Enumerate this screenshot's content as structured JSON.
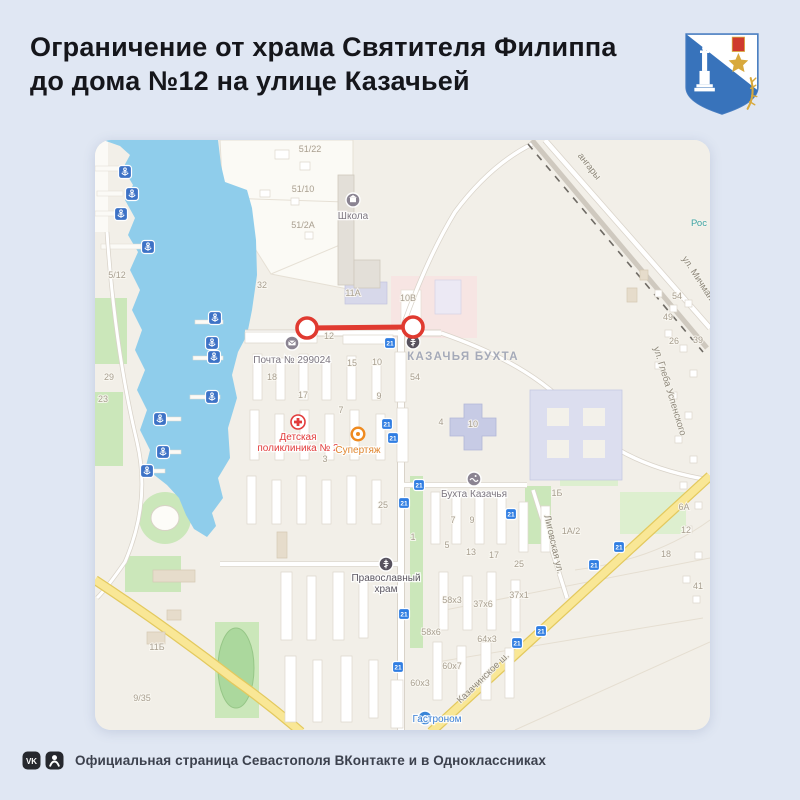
{
  "colors": {
    "page_bg": "#e0e7f3",
    "map_bg": "#f2efe8",
    "water": "#8fcdeb",
    "restriction_red": "#e03a30",
    "yellow_road": "#f9e796",
    "transit_blue": "#2f7de2",
    "anchor_blue": "#3d72c6"
  },
  "header": {
    "title_line1": "Ограничение от храма Святителя Филиппа",
    "title_line2": "до дома №12 на улице Казачьей",
    "emblem_name": "sevastopol-coat-of-arms"
  },
  "footer": {
    "text": "Официальная страница Севастополя ВКонтакте и в Одноклассниках",
    "icons": [
      "vk-icon",
      "ok-icon"
    ]
  },
  "map": {
    "area_label": {
      "text": "КАЗАЧЬЯ БУХТА",
      "x": 368,
      "y": 220
    },
    "restriction": {
      "x1": 212,
      "y1": 188,
      "x2": 318,
      "y2": 187,
      "color": "#e03a30"
    },
    "street_labels": [
      {
        "text": "ангары",
        "x": 492,
        "y": 28,
        "angle": 52
      },
      {
        "text": "ул. Мичманская",
        "x": 606,
        "y": 148,
        "angle": 57
      },
      {
        "text": "ул. Глеба Успенского",
        "x": 572,
        "y": 252,
        "angle": 73
      },
      {
        "text": "Лиговская ул.",
        "x": 456,
        "y": 405,
        "angle": 77
      },
      {
        "text": "Казачинское ш.",
        "x": 390,
        "y": 540,
        "angle": -44
      },
      {
        "text": "Рос",
        "x": 604,
        "y": 86,
        "angle": 0,
        "color": "#3fa3a3"
      }
    ],
    "poi": [
      {
        "name": "school",
        "icon": "school-icon",
        "x": 258,
        "y": 60,
        "lines": [
          "Школа"
        ],
        "ly": 79,
        "color": "#7d7781"
      },
      {
        "name": "post-office",
        "icon": "post-icon",
        "x": 197,
        "y": 203,
        "lines": [
          "Почта № 299024"
        ],
        "ly": 223,
        "color": "#7d7781"
      },
      {
        "name": "church-svyatitelya-filippa",
        "icon": "church-icon",
        "x": 318,
        "y": 202,
        "lines": [],
        "ly": 0,
        "color": "#5a5560"
      },
      {
        "name": "children-clinic",
        "icon": "clinic-icon",
        "x": 203,
        "y": 282,
        "lines": [
          "Детская",
          "поликлиника № 2"
        ],
        "ly": 300,
        "color": "#e23b3b"
      },
      {
        "name": "supertyazh",
        "icon": "ring-icon",
        "x": 263,
        "y": 294,
        "lines": [
          "Супертяж"
        ],
        "ly": 313,
        "color": "#e0862f"
      },
      {
        "name": "bukhta-kazachya",
        "icon": "wave-icon",
        "x": 379,
        "y": 339,
        "lines": [
          "Бухта Казачья"
        ],
        "ly": 357,
        "color": "#7d7781"
      },
      {
        "name": "orthodox-church",
        "icon": "church-icon",
        "x": 291,
        "y": 424,
        "lines": [
          "Православный",
          "храм"
        ],
        "ly": 441,
        "color": "#5a5560"
      },
      {
        "name": "gastronom",
        "icon": "shop-icon",
        "x": 330,
        "y": 578,
        "lines": [
          "Гастроном"
        ],
        "ly": 582,
        "color": "#3a7fd5",
        "lx": 342,
        "align": "start"
      }
    ],
    "transit": {
      "route": "21",
      "positions": [
        [
          295,
          203
        ],
        [
          292,
          284
        ],
        [
          298,
          298
        ],
        [
          324,
          345
        ],
        [
          309,
          363
        ],
        [
          309,
          474
        ],
        [
          416,
          374
        ],
        [
          524,
          407
        ],
        [
          499,
          425
        ],
        [
          446,
          491
        ],
        [
          422,
          503
        ],
        [
          303,
          527
        ]
      ]
    },
    "anchors": [
      [
        30,
        32
      ],
      [
        37,
        54
      ],
      [
        26,
        74
      ],
      [
        53,
        107
      ],
      [
        120,
        178
      ],
      [
        117,
        203
      ],
      [
        119,
        217
      ],
      [
        117,
        257
      ],
      [
        65,
        279
      ],
      [
        68,
        312
      ],
      [
        52,
        331
      ]
    ],
    "building_labels": [
      [
        "51/22",
        215,
        12
      ],
      [
        "51/10",
        208,
        52
      ],
      [
        "51/2А",
        208,
        88
      ],
      [
        "32",
        167,
        148
      ],
      [
        "5/12",
        22,
        138
      ],
      [
        "29",
        14,
        240
      ],
      [
        "23",
        8,
        262
      ],
      [
        "11А",
        258,
        156
      ],
      [
        "10В",
        313,
        161
      ],
      [
        "12",
        234,
        199
      ],
      [
        "15",
        257,
        226
      ],
      [
        "10",
        282,
        225
      ],
      [
        "18",
        177,
        240
      ],
      [
        "17",
        208,
        258
      ],
      [
        "7",
        246,
        273
      ],
      [
        "9",
        284,
        259
      ],
      [
        "54",
        320,
        240
      ],
      [
        "4",
        346,
        285
      ],
      [
        "10",
        378,
        287
      ],
      [
        "3",
        230,
        322
      ],
      [
        "25",
        288,
        368
      ],
      [
        "1",
        318,
        400
      ],
      [
        "7",
        358,
        383
      ],
      [
        "9",
        377,
        383
      ],
      [
        "5",
        352,
        408
      ],
      [
        "13",
        376,
        415
      ],
      [
        "17",
        399,
        418
      ],
      [
        "25",
        424,
        427
      ],
      [
        "1Б",
        462,
        356
      ],
      [
        "1А/2",
        476,
        394
      ],
      [
        "6А",
        589,
        370
      ],
      [
        "12",
        591,
        393
      ],
      [
        "18",
        571,
        417
      ],
      [
        "41",
        603,
        449
      ],
      [
        "37х1",
        424,
        458
      ],
      [
        "37х6",
        388,
        467
      ],
      [
        "58х3",
        357,
        463
      ],
      [
        "58х6",
        336,
        495
      ],
      [
        "64х3",
        392,
        502
      ],
      [
        "60х7",
        357,
        529
      ],
      [
        "60х3",
        325,
        546
      ],
      [
        "11Б",
        62,
        510
      ],
      [
        "9/35",
        47,
        561
      ],
      [
        "54",
        582,
        159
      ],
      [
        "49",
        573,
        180
      ],
      [
        "26",
        579,
        204
      ],
      [
        "39",
        603,
        203
      ]
    ]
  }
}
